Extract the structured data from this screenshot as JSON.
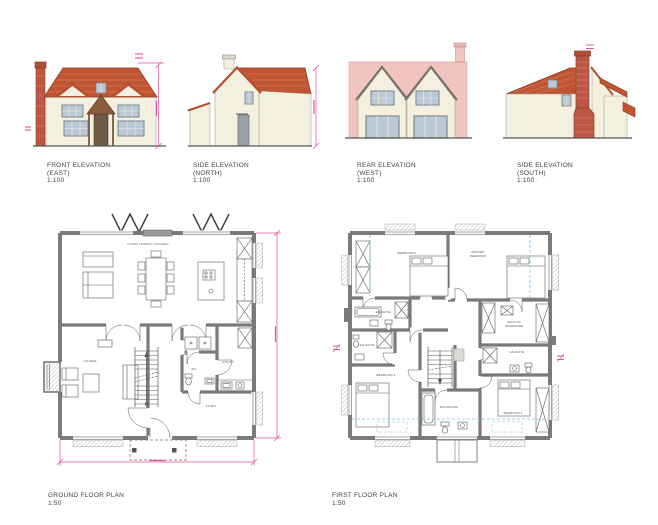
{
  "drawing": {
    "background": "#ffffff",
    "colors": {
      "roof_red": "#c05534",
      "roof_texture": "#d8825f",
      "wall_cream": "#f4f0df",
      "render_pink": "#f0c5bf",
      "brick": "#bd5743",
      "window_glass": "#b9c9d6",
      "window_frame": "#7d8590",
      "door_grey": "#9aa0a8",
      "porch_brown": "#8a5c3c",
      "plan_wall_grey": "#7a7a7a",
      "dimension_pink": "#e0509e",
      "ceiling_guide_blue": "#7cc3e8",
      "caption_text": "#3f3f3a"
    }
  },
  "elevations": {
    "front": {
      "title": "FRONT ELEVATION",
      "subtitle": "(EAST)",
      "scale": "1:100"
    },
    "north": {
      "title": "SIDE ELEVATION",
      "subtitle": "(NORTH)",
      "scale": "1:100"
    },
    "rear": {
      "title": "REAR ELEVATION",
      "subtitle": "(WEST)",
      "scale": "1:100"
    },
    "south": {
      "title": "SIDE ELEVATION",
      "subtitle": "(SOUTH)",
      "scale": "1:100"
    }
  },
  "plans": {
    "ground": {
      "title": "GROUND FLOOR PLAN",
      "scale": "1:50",
      "rooms": {
        "living": "LIVING / DINING / KITCHEN",
        "lounge": "LOUNGE",
        "wc": "WC",
        "utility": "UTILITY",
        "study": "STUDY"
      }
    },
    "first": {
      "title": "FIRST FLOOR PLAN",
      "scale": "1:50",
      "rooms": {
        "bedroom2": "BEDROOM 2",
        "master1": "MASTER",
        "master2": "BEDROOM",
        "wardrobe1": "WALK-IN",
        "wardrobe2": "WARDROBE",
        "ensuite": "EN-SUITE",
        "bedroom3": "BEDROOM 3",
        "bathroom": "BATHROOM",
        "bedroom4": "BEDROOM 4"
      }
    }
  }
}
